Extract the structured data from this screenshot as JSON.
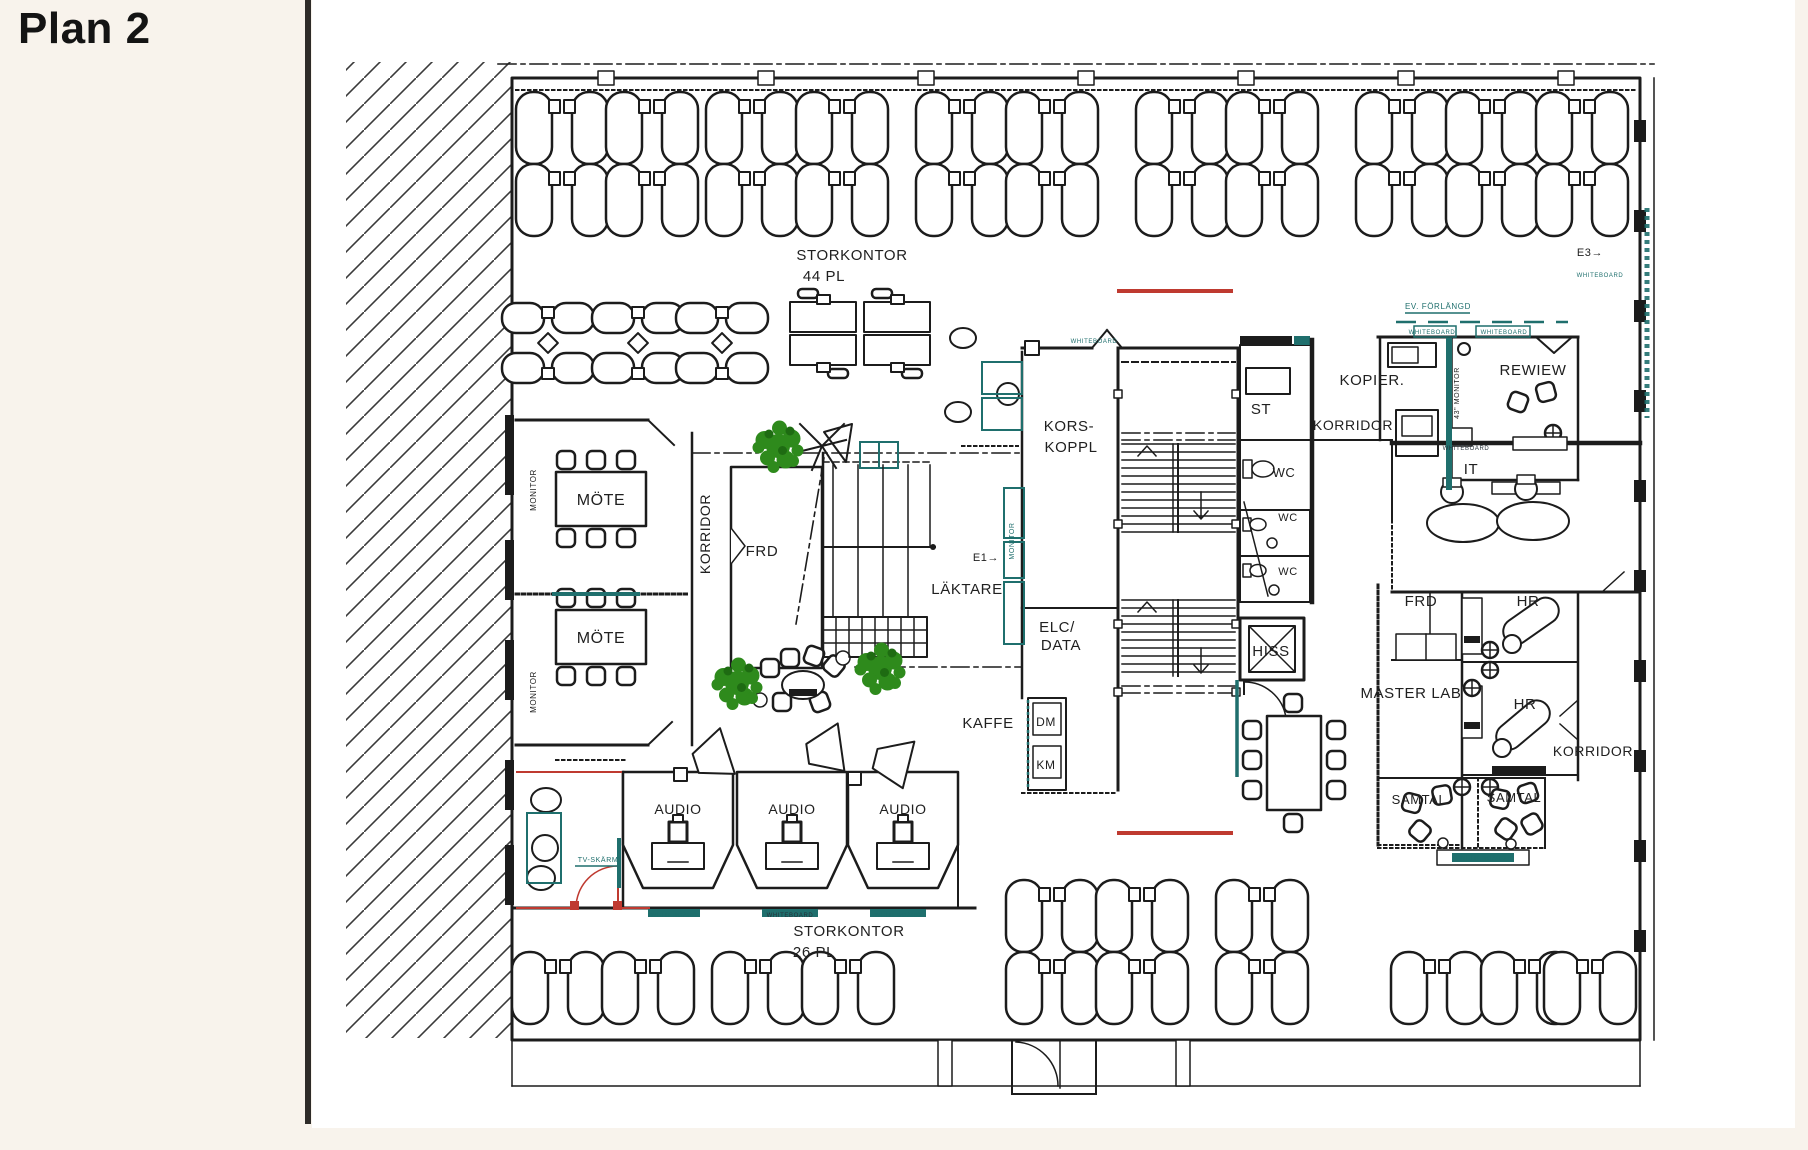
{
  "page": {
    "title": "Plan 2",
    "background": "#f8f3ec",
    "paper_color": "#ffffff",
    "divider_color": "#2e2b28"
  },
  "palette": {
    "wall": "#1c1c1c",
    "teal_accent": "#1f6f6d",
    "red_accent": "#bf3a30",
    "plant_green": "#2e8a1c"
  },
  "plan": {
    "labels": [
      {
        "text": "STORKONTOR",
        "x": 852,
        "y": 260,
        "size": 15
      },
      {
        "text": "44  PL",
        "x": 824,
        "y": 281,
        "size": 15
      },
      {
        "text": "MONITOR",
        "x": 536,
        "y": 490,
        "size": 8,
        "rotate": -90
      },
      {
        "text": "MÖTE",
        "x": 601,
        "y": 505,
        "size": 16
      },
      {
        "text": "MONITOR",
        "x": 536,
        "y": 692,
        "size": 8,
        "rotate": -90
      },
      {
        "text": "MÖTE",
        "x": 601,
        "y": 643,
        "size": 16
      },
      {
        "text": "KORRIDOR",
        "x": 710,
        "y": 534,
        "size": 14,
        "rotate": -90
      },
      {
        "text": "FRD",
        "x": 762,
        "y": 556,
        "size": 15
      },
      {
        "text": "KORS-",
        "x": 1069,
        "y": 431,
        "size": 15
      },
      {
        "text": "KOPPL",
        "x": 1071,
        "y": 452,
        "size": 15
      },
      {
        "text": "ST",
        "x": 1261,
        "y": 414,
        "size": 15
      },
      {
        "text": "KORRIDOR",
        "x": 1353,
        "y": 430,
        "size": 14
      },
      {
        "text": "WC",
        "x": 1284,
        "y": 477,
        "size": 13
      },
      {
        "text": "WC",
        "x": 1288,
        "y": 521,
        "size": 11
      },
      {
        "text": "WC",
        "x": 1288,
        "y": 575,
        "size": 11
      },
      {
        "text": "KOPIER.",
        "x": 1372,
        "y": 385,
        "size": 15
      },
      {
        "text": "REWIEW",
        "x": 1533,
        "y": 375,
        "size": 15
      },
      {
        "text": "43\" MONITOR",
        "x": 1459,
        "y": 393,
        "size": 7,
        "rotate": -90
      },
      {
        "text": "EV. FÖRLÄNGD",
        "x": 1438,
        "y": 309,
        "size": 8,
        "color": "c-teal"
      },
      {
        "text": "WHITEBOARD",
        "x": 1432,
        "y": 334,
        "size": 6,
        "color": "c-teal"
      },
      {
        "text": "WHITEBOARD",
        "x": 1504,
        "y": 334,
        "size": 6,
        "color": "c-teal"
      },
      {
        "text": "WHITEBOARD",
        "x": 1094,
        "y": 343,
        "size": 6,
        "color": "c-teal"
      },
      {
        "text": "WHITEBOARD",
        "x": 1466,
        "y": 450,
        "size": 6,
        "color": "c-dark"
      },
      {
        "text": "IT",
        "x": 1471,
        "y": 474,
        "size": 15
      },
      {
        "text": "FRD",
        "x": 1421,
        "y": 606,
        "size": 15
      },
      {
        "text": "HR",
        "x": 1528,
        "y": 606,
        "size": 15
      },
      {
        "text": "MASTER  LAB",
        "x": 1411,
        "y": 698,
        "size": 15
      },
      {
        "text": "HR",
        "x": 1525,
        "y": 709,
        "size": 15
      },
      {
        "text": "KORRIDOR",
        "x": 1593,
        "y": 756,
        "size": 14
      },
      {
        "text": "HISS",
        "x": 1271,
        "y": 656,
        "size": 15
      },
      {
        "text": "SAMTAL",
        "x": 1419,
        "y": 804,
        "size": 13
      },
      {
        "text": "SAMTAL",
        "x": 1514,
        "y": 802,
        "size": 13
      },
      {
        "text": "WHITEBOARD",
        "x": 1483,
        "y": 860,
        "size": 6,
        "color": "c-teal"
      },
      {
        "text": "LÄKTARE",
        "x": 967,
        "y": 594,
        "size": 15
      },
      {
        "text": "E1→",
        "x": 986,
        "y": 561,
        "size": 11
      },
      {
        "text": "MONITOR",
        "x": 1014,
        "y": 541,
        "size": 7,
        "rotate": -90,
        "color": "c-teal"
      },
      {
        "text": "ELC/",
        "x": 1057,
        "y": 632,
        "size": 15
      },
      {
        "text": "DATA",
        "x": 1061,
        "y": 650,
        "size": 15
      },
      {
        "text": "KAFFE",
        "x": 988,
        "y": 728,
        "size": 15
      },
      {
        "text": "DM",
        "x": 1046,
        "y": 726,
        "size": 12
      },
      {
        "text": "KM",
        "x": 1046,
        "y": 769,
        "size": 12
      },
      {
        "text": "AUDIO",
        "x": 678,
        "y": 814,
        "size": 14
      },
      {
        "text": "AUDIO",
        "x": 792,
        "y": 814,
        "size": 14
      },
      {
        "text": "AUDIO",
        "x": 903,
        "y": 814,
        "size": 14
      },
      {
        "text": "WHITEBOARD",
        "x": 674,
        "y": 917,
        "size": 6,
        "color": "c-teal"
      },
      {
        "text": "WHITEBOARD",
        "x": 790,
        "y": 917,
        "size": 6,
        "color": "c-dark"
      },
      {
        "text": "WHITEBOARD",
        "x": 898,
        "y": 917,
        "size": 6,
        "color": "c-teal"
      },
      {
        "text": "STORKONTOR",
        "x": 849,
        "y": 936,
        "size": 15
      },
      {
        "text": "26  PL",
        "x": 814,
        "y": 957,
        "size": 15
      },
      {
        "text": "E3→",
        "x": 1590,
        "y": 256,
        "size": 11
      },
      {
        "text": "WHITEBOARD",
        "x": 1600,
        "y": 277,
        "size": 6,
        "color": "c-teal"
      },
      {
        "text": "TV-SKÄRM",
        "x": 598,
        "y": 862,
        "size": 7,
        "color": "c-teal"
      }
    ],
    "desk_pairs": [
      {
        "x": 562,
        "y": 92
      },
      {
        "x": 652,
        "y": 92
      },
      {
        "x": 752,
        "y": 92
      },
      {
        "x": 842,
        "y": 92
      },
      {
        "x": 962,
        "y": 92
      },
      {
        "x": 1052,
        "y": 92
      },
      {
        "x": 1182,
        "y": 92
      },
      {
        "x": 1272,
        "y": 92
      },
      {
        "x": 1402,
        "y": 92
      },
      {
        "x": 1492,
        "y": 92
      },
      {
        "x": 1582,
        "y": 92
      },
      {
        "x": 562,
        "y": 164
      },
      {
        "x": 652,
        "y": 164
      },
      {
        "x": 752,
        "y": 164
      },
      {
        "x": 842,
        "y": 164
      },
      {
        "x": 962,
        "y": 164
      },
      {
        "x": 1052,
        "y": 164
      },
      {
        "x": 1182,
        "y": 164
      },
      {
        "x": 1272,
        "y": 164
      },
      {
        "x": 1402,
        "y": 164
      },
      {
        "x": 1492,
        "y": 164
      },
      {
        "x": 1582,
        "y": 164
      },
      {
        "x": 1052,
        "y": 880
      },
      {
        "x": 1142,
        "y": 880
      },
      {
        "x": 1262,
        "y": 880
      },
      {
        "x": 558,
        "y": 952
      },
      {
        "x": 648,
        "y": 952
      },
      {
        "x": 758,
        "y": 952
      },
      {
        "x": 848,
        "y": 952
      },
      {
        "x": 1052,
        "y": 952
      },
      {
        "x": 1142,
        "y": 952
      },
      {
        "x": 1262,
        "y": 952
      },
      {
        "x": 1437,
        "y": 952
      },
      {
        "x": 1527,
        "y": 952
      },
      {
        "x": 1590,
        "y": 952
      }
    ],
    "quad_pods": [
      {
        "x": 548,
        "y": 343
      },
      {
        "x": 638,
        "y": 343
      },
      {
        "x": 722,
        "y": 343
      }
    ],
    "table_pairs": [
      {
        "x": 790,
        "y": 302
      },
      {
        "x": 864,
        "y": 302
      }
    ],
    "plants": [
      {
        "x": 778,
        "y": 446
      },
      {
        "x": 880,
        "y": 668
      },
      {
        "x": 737,
        "y": 683
      }
    ]
  }
}
